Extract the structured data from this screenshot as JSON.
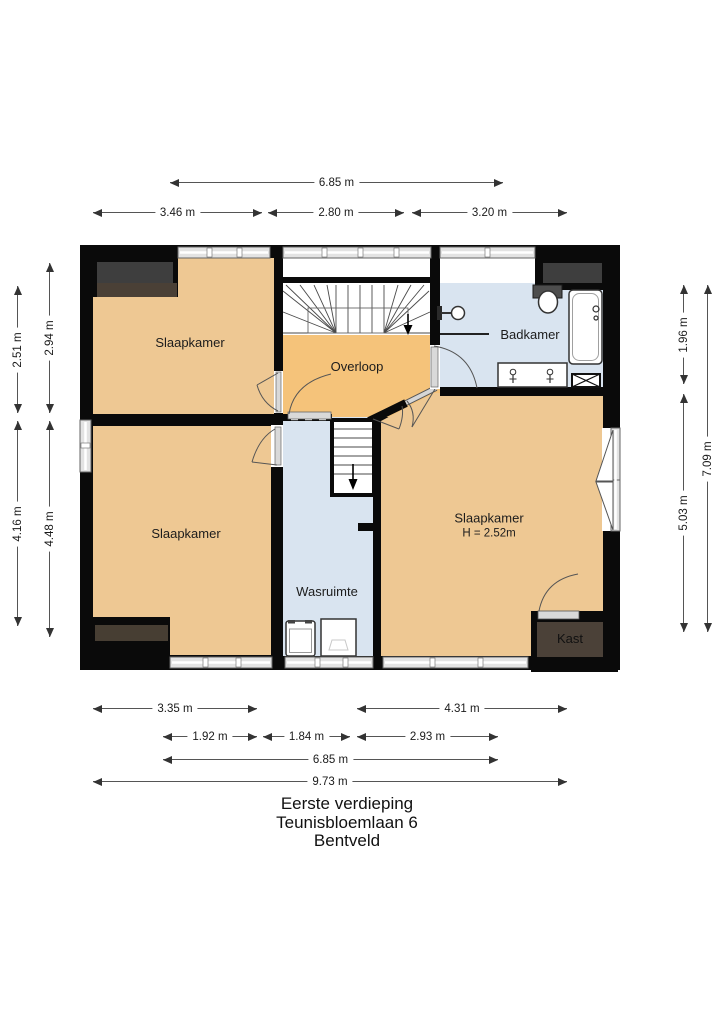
{
  "title": {
    "line1": "Eerste verdieping",
    "line2": "Teunisbloemlaan 6",
    "line3": "Bentveld"
  },
  "rooms": {
    "slaapkamer_tl": "Slaapkamer",
    "slaapkamer_bl": "Slaapkamer",
    "slaapkamer_r": "Slaapkamer",
    "slaapkamer_r_height": "H = 2.52m",
    "overloop": "Overloop",
    "badkamer": "Badkamer",
    "wasruimte": "Wasruimte",
    "kast": "Kast"
  },
  "dims": {
    "top_total": "6.85 m",
    "top_1": "3.46 m",
    "top_2": "2.80 m",
    "top_3": "3.20 m",
    "left_outer_1": "2.51 m",
    "left_outer_2": "4.16 m",
    "left_inner_1": "2.94 m",
    "left_inner_2": "4.48 m",
    "right_inner_1": "1.96 m",
    "right_inner_2": "5.03 m",
    "right_outer": "7.09 m",
    "bottom_r1_1": "3.35 m",
    "bottom_r1_2": "4.31 m",
    "bottom_r2_1": "1.92 m",
    "bottom_r2_2": "1.84 m",
    "bottom_r2_3": "2.93 m",
    "bottom_r3": "6.85 m",
    "bottom_r4": "9.73 m"
  },
  "colors": {
    "wall": "#0a0a0a",
    "bedroom_floor": "#eec893",
    "landing_floor": "#f5c37a",
    "wet_room_floor": "#d9e4f0",
    "closet_floor": "#4b4138",
    "dormer_gray": "#3e3e3e",
    "dormer_wood": "#4a4036",
    "window_band": "#e3e3e3"
  }
}
